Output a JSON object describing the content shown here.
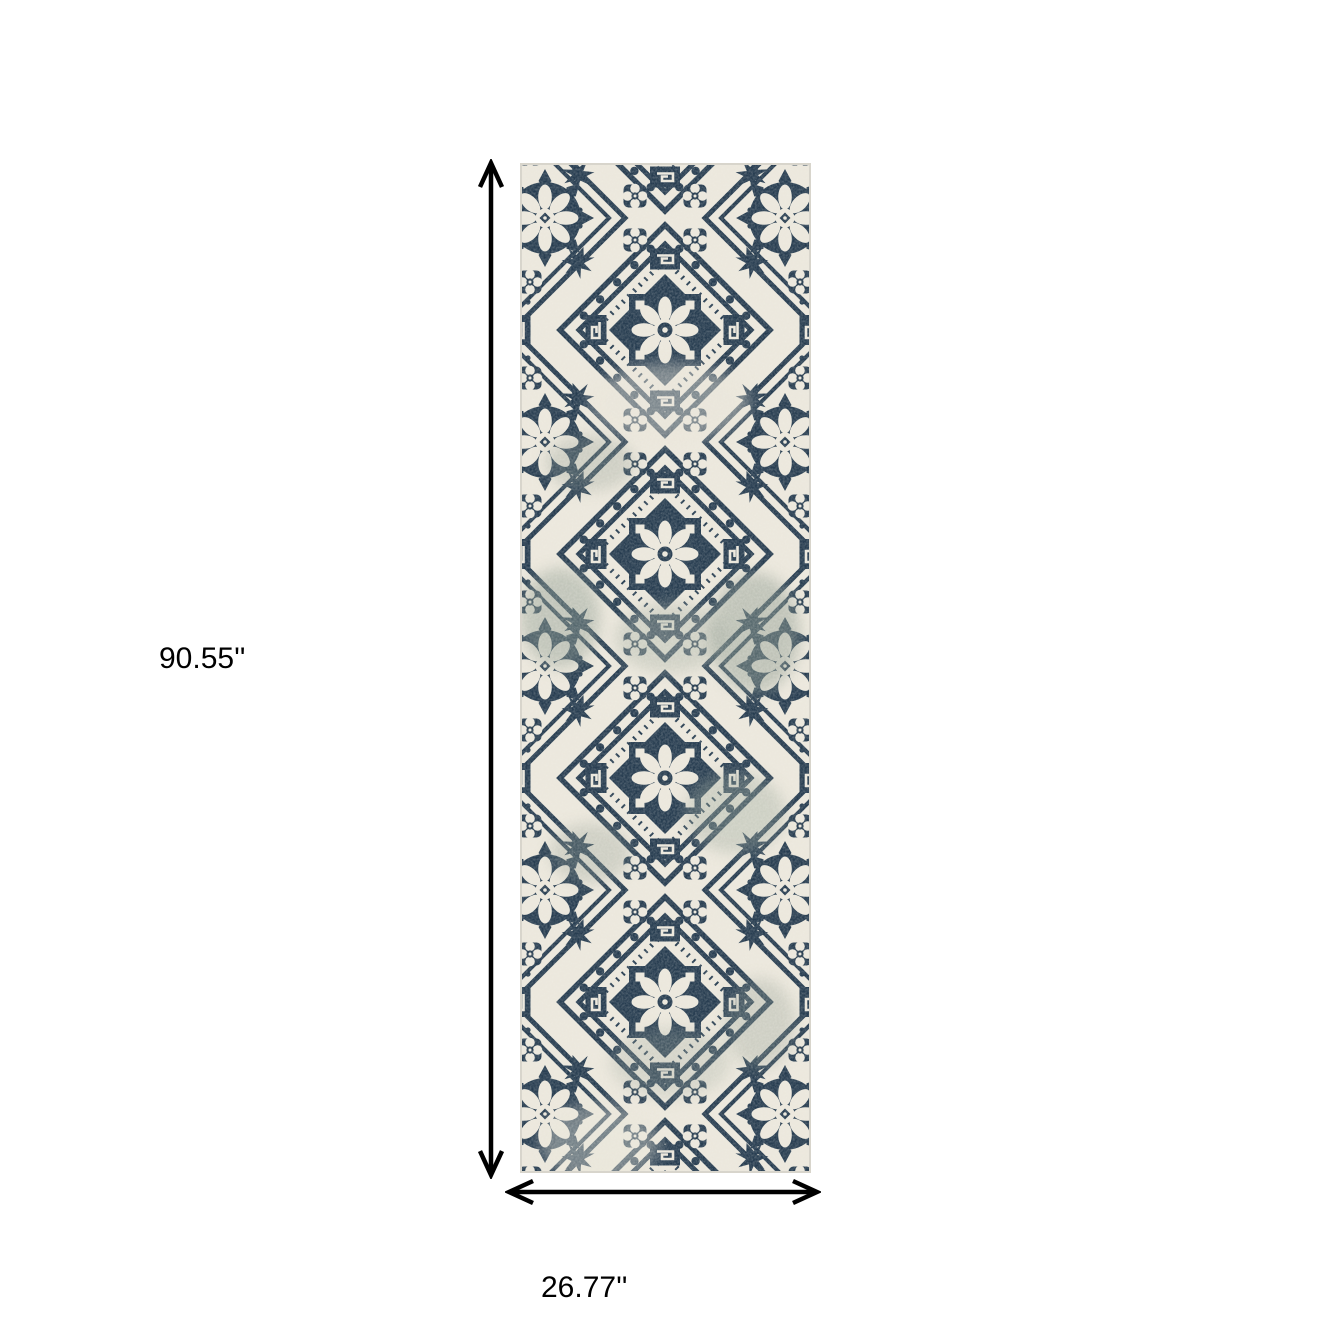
{
  "figure": {
    "description": "Blue and ivory distressed medallion runner rug with dimension arrows",
    "rug": {
      "pattern": "distressed navy floral medallion trellis on ivory",
      "colors": {
        "navy": "#263c50",
        "ivory": "#ece8dd",
        "faded_sage": "#8e9b90",
        "edge": "#d8d5cc"
      }
    },
    "dimensions": {
      "height_label": "90.55''",
      "width_label": "26.77''",
      "arrow_color": "#000000"
    }
  }
}
